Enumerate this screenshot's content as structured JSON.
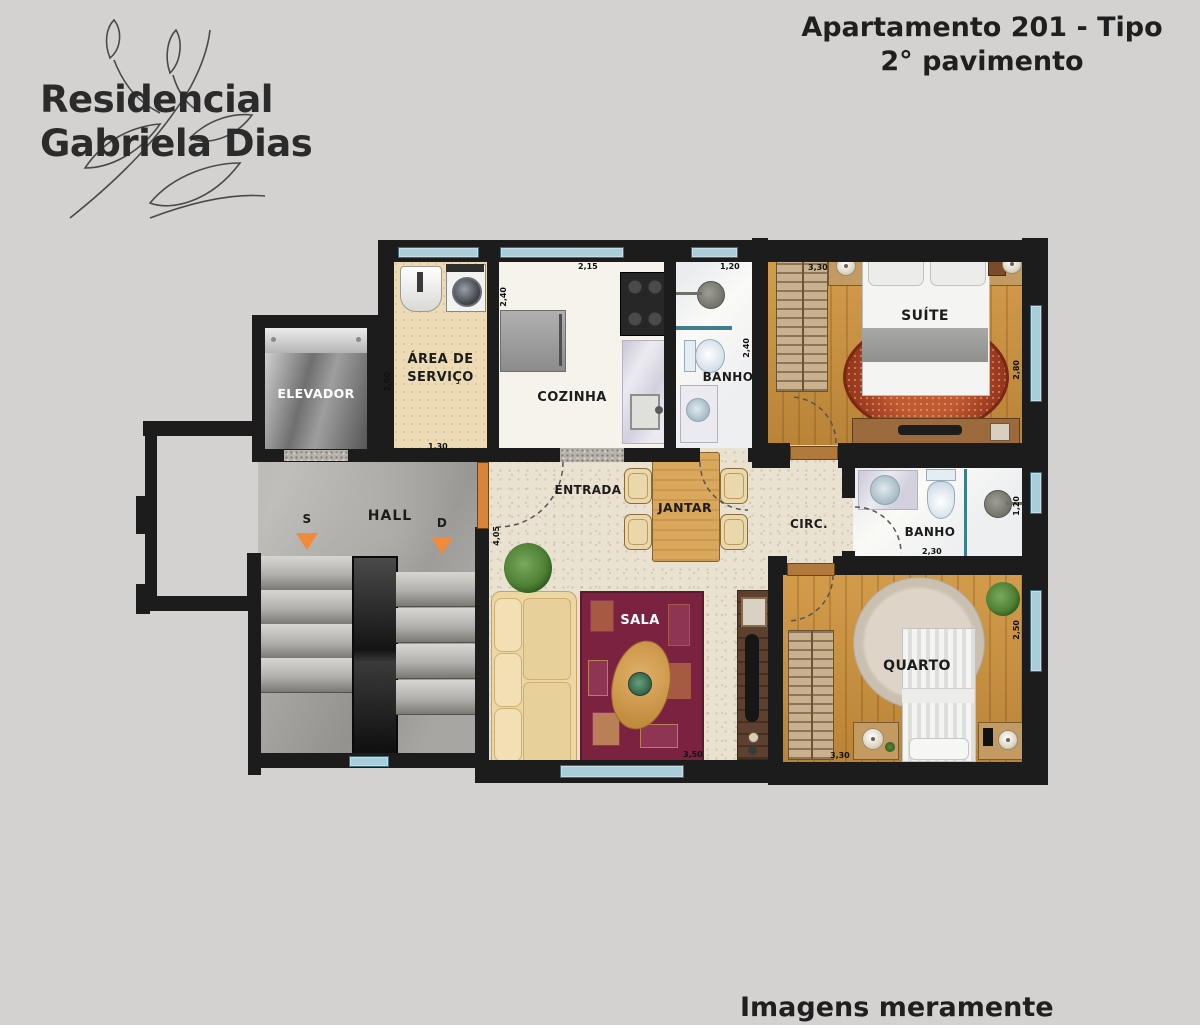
{
  "header": {
    "logo_line1": "Residencial",
    "logo_line2": "Gabriela Dias",
    "title_line1": "Apartamento 201 - Tipo",
    "title_line2": "2° pavimento"
  },
  "footer": {
    "disclaimer": "Imagens meramente ilustrativas"
  },
  "plan": {
    "elevador": {
      "label": "ELEVADOR"
    },
    "area_servico": {
      "label_1": "ÁREA DE",
      "label_2": "SERVIÇO",
      "dim_w": "1,30",
      "dim_h": "2,50"
    },
    "cozinha": {
      "label": "COZINHA",
      "dim_w": "2,15",
      "dim_h": "2,40"
    },
    "banho_social": {
      "label": "BANHO",
      "dim_w": "1,20",
      "dim_h": "2,40"
    },
    "suite": {
      "label": "SUÍTE",
      "dim_w": "3,30",
      "dim_h": "2,80"
    },
    "hall": {
      "label": "HALL",
      "stair_up": "S",
      "stair_down": "D"
    },
    "entrada": {
      "label": "ENTRADA",
      "dim_h": "4,05"
    },
    "jantar": {
      "label": "JANTAR"
    },
    "circulacao": {
      "label": "CIRC."
    },
    "banho_2": {
      "label": "BANHO",
      "dim_w": "2,30",
      "dim_h": "1,20"
    },
    "sala": {
      "label": "SALA",
      "dim_w": "3,50"
    },
    "quarto": {
      "label": "QUARTO",
      "dim_w": "3,30",
      "dim_h": "2,50"
    }
  },
  "colors": {
    "background": "#d3d2d0",
    "wall": "#1c1c1c",
    "window": "#a9cdd9",
    "wood_floor": "#c9913f",
    "service_floor": "#eddbb6",
    "travertine_floor": "#e9e2d0",
    "concrete_floor": "#a8a6a2",
    "rug_sala": "#7a2240",
    "rug_suite": "#b4502d",
    "stair_arrow": "#f28a3c"
  }
}
